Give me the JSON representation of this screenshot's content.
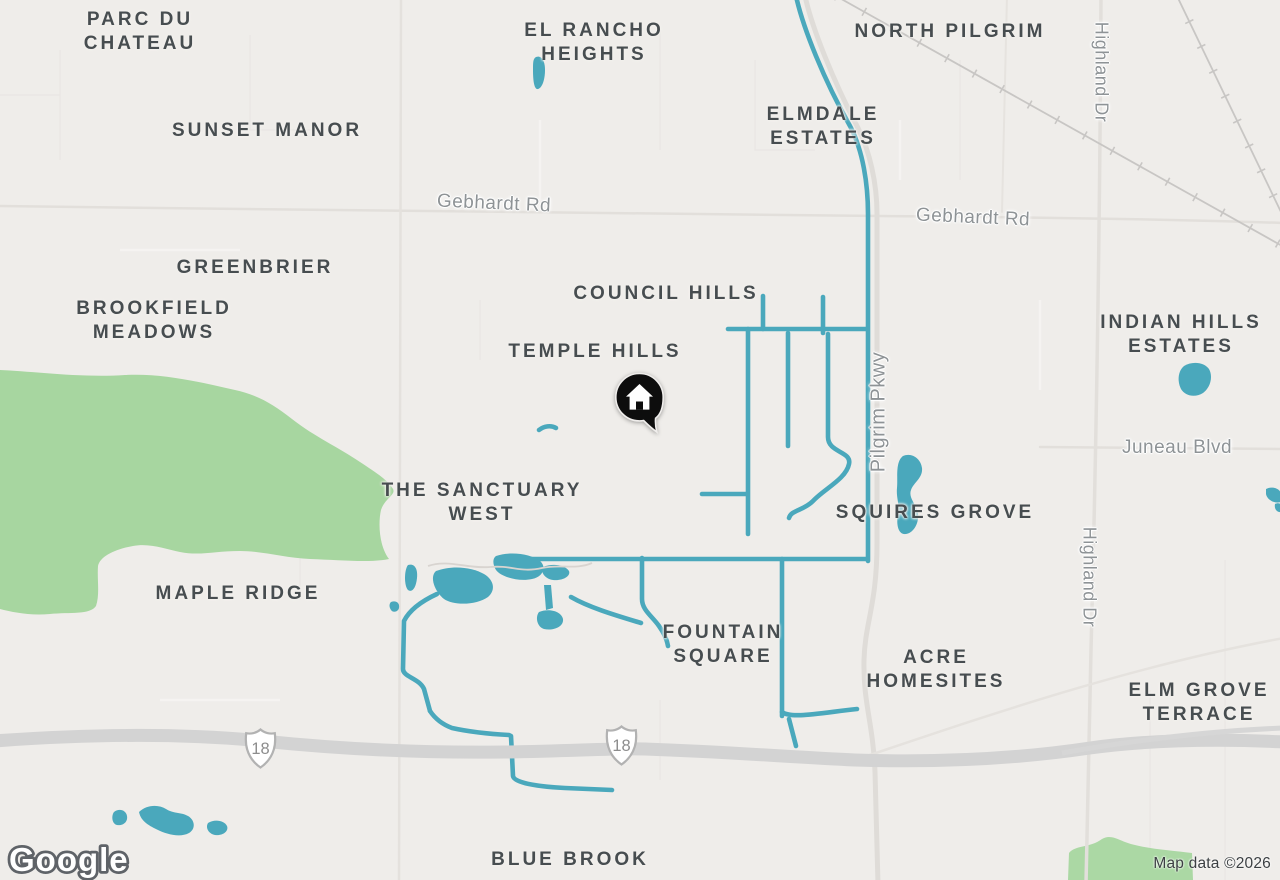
{
  "map": {
    "type": "road-map",
    "provider_logo": "Google",
    "attribution": "Map data ©2026",
    "marker": {
      "kind": "home-listing-pin"
    },
    "highway_shields": [
      {
        "route": "18"
      },
      {
        "route": "18"
      }
    ],
    "area_labels": {
      "parc_du_chateau": {
        "lines": [
          "PARC DU",
          "CHATEAU"
        ]
      },
      "el_rancho_heights": {
        "lines": [
          "EL RANCHO",
          "HEIGHTS"
        ]
      },
      "north_pilgrim": {
        "lines": [
          "NORTH PILGRIM"
        ]
      },
      "sunset_manor": {
        "lines": [
          "SUNSET MANOR"
        ]
      },
      "elmdale_estates": {
        "lines": [
          "ELMDALE",
          "ESTATES"
        ]
      },
      "greenbrier": {
        "lines": [
          "GREENBRIER"
        ]
      },
      "council_hills": {
        "lines": [
          "COUNCIL HILLS"
        ]
      },
      "brookfield_meadows": {
        "lines": [
          "BROOKFIELD",
          "MEADOWS"
        ]
      },
      "temple_hills": {
        "lines": [
          "TEMPLE HILLS"
        ]
      },
      "indian_hills_estates": {
        "lines": [
          "INDIAN HILLS",
          "ESTATES"
        ]
      },
      "the_sanctuary_west": {
        "lines": [
          "THE SANCTUARY",
          "WEST"
        ]
      },
      "squires_grove": {
        "lines": [
          "SQUIRES GROVE"
        ]
      },
      "maple_ridge": {
        "lines": [
          "MAPLE RIDGE"
        ]
      },
      "fountain_square": {
        "lines": [
          "FOUNTAIN",
          "SQUARE"
        ]
      },
      "acre_homesites": {
        "lines": [
          "ACRE",
          "HOMESITES"
        ]
      },
      "elm_grove_terrace": {
        "lines": [
          "ELM GROVE",
          "TERRACE"
        ]
      },
      "blue_brook": {
        "lines": [
          "BLUE BROOK"
        ]
      }
    },
    "road_labels": {
      "gebhardt_rd_west": {
        "text": "Gebhardt Rd"
      },
      "gebhardt_rd_east": {
        "text": "Gebhardt Rd"
      },
      "pilgrim_pkwy": {
        "text": "Pilgrim Pkwy"
      },
      "highland_dr_north": {
        "text": "Highland Dr"
      },
      "highland_dr_south": {
        "text": "Highland Dr"
      },
      "juneau_blvd": {
        "text": "Juneau Blvd"
      }
    },
    "colors": {
      "background": "#efedea",
      "park_green": "#a7d6a0",
      "water_teal": "#4aa8bc",
      "highway_gray": "#d3d3d3",
      "railroad_gray": "#c8c6c4",
      "minor_road": "#e2dfdb",
      "area_label": "#474d50",
      "road_label": "#8e9396",
      "marker_black": "#0d0d0d",
      "attribution_text": "#3c4043"
    }
  }
}
